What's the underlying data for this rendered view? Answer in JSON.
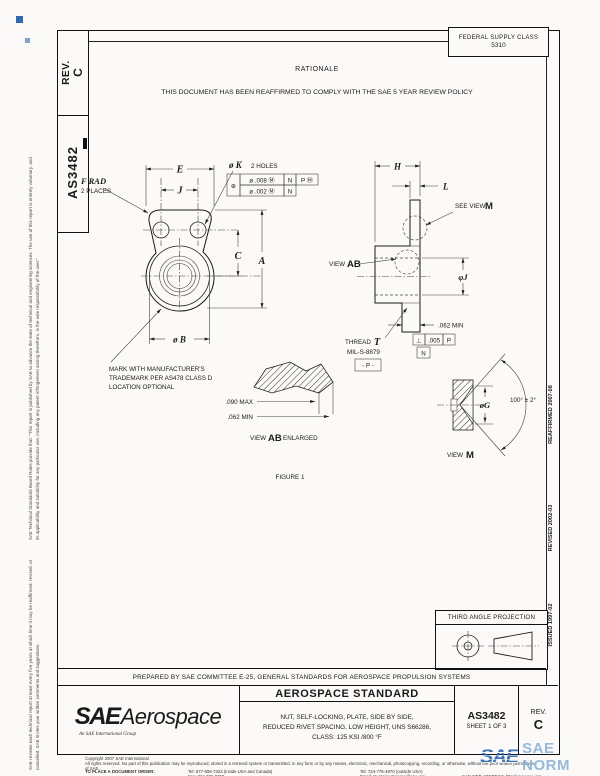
{
  "header": {
    "rev_label": "REV.",
    "rev_value": "C",
    "doc_number": "AS3482",
    "fsc_label": "FEDERAL SUPPLY CLASS",
    "fsc_value": "5310"
  },
  "rationale": {
    "title": "RATIONALE",
    "body": "THIS DOCUMENT HAS BEEN REAFFIRMED TO COMPLY WITH THE SAE 5 YEAR REVIEW POLICY"
  },
  "sidebar_left": {
    "disclaimer_1": "SAE Technical Standards Board Rules provide that: \"This report is published by SAE to advance the state of technical and engineering sciences. The use of this report is entirely voluntary, and its applicability and suitability for any particular use, including any patent infringement arising therefrom, is the sole responsibility of the user.\"",
    "disclaimer_2": "SAE reviews each technical report at least every five years at which time it may be reaffirmed, revised, or cancelled. SAE invites your written comments and suggestions."
  },
  "margin_right": {
    "reaffirmed": "REAFFIRMED 2007-08",
    "revised": "REVISED 2002-03",
    "issued": "ISSUED 1997-02"
  },
  "figure": {
    "caption": "FIGURE 1",
    "labels": {
      "e": "E",
      "j": "J",
      "c": "C",
      "a": "A",
      "b": "ø B",
      "h": "H",
      "l": "L",
      "phij": "φJ",
      "frad": "F RAD",
      "frad_note": "2 PLACES",
      "k": "ø K",
      "k_note": "2 HOLES",
      "fcf_pos": "⊕",
      "fcf_r1a": "ø .008 Ⓜ",
      "fcf_r1b": "N",
      "fcf_r1c": "P Ⓜ",
      "fcf_r2a": "ø .002 Ⓜ",
      "fcf_r2b": "N",
      "see_view": "SEE VIEW",
      "view": "VIEW",
      "m": "M",
      "ab": "AB",
      "enlarged": "ENLARGED",
      "min062_side": ".062 MIN",
      "perp_sym": "⊥",
      "perp_val": ".005",
      "perp_datum": "P",
      "datum_n": "N",
      "thread": "THREAD",
      "thread_t": "T",
      "thread_spec": "MIL-S-8879",
      "datum_p": "- P -",
      "mark1": "MARK WITH MANUFACTURER'S",
      "mark2": "TRADEMARK PER AS478 CLASS D",
      "mark3": "LOCATION OPTIONAL",
      "max090": ".090 MAX",
      "min062": ".062 MIN",
      "og": "øG",
      "angle": "100° ± 2°"
    }
  },
  "projection": {
    "title": "THIRD ANGLE PROJECTION"
  },
  "prepared_by": "PREPARED BY SAE COMMITTEE E-25, GENERAL STANDARDS FOR AEROSPACE PROPULSION SYSTEMS",
  "title_block": {
    "logo_main": "SAE",
    "logo_sub": "Aerospace",
    "logo_tagline": "An SAE International Group",
    "kind": "AEROSPACE STANDARD",
    "line1": "NUT, SELF-LOCKING, PLATE, SIDE BY SIDE,",
    "line2": "REDUCED RIVET SPACING, LOW HEIGHT, UNS S66286,",
    "line3": "CLASS: 125 KSI /800 °F",
    "number": "AS3482",
    "sheet": "SHEET 1 OF 3",
    "rev_label": "REV.",
    "rev_value": "C"
  },
  "footer": {
    "copyright": "Copyright 2007 SAE International",
    "rights": "All rights reserved. No part of this publication may be reproduced, stored in a retrieval system or transmitted, in any form or by any means, electronic, mechanical, photocopying, recording, or otherwise, without the prior written permission of SAE.",
    "order_label": "TO PLACE A DOCUMENT ORDER:",
    "tel1": "Tel: 877-606-7323 (inside USA and Canada)",
    "tel2": "Tel: 724-776-4970 (outside USA)",
    "fax": "Fax: 724-776-0790",
    "email": "Email: CustomerService@sae.org",
    "web": "SAE WEB ADDRESS: http://www.sae.org"
  },
  "watermark": {
    "sae": "SAE",
    "name": "SAE NORM"
  }
}
